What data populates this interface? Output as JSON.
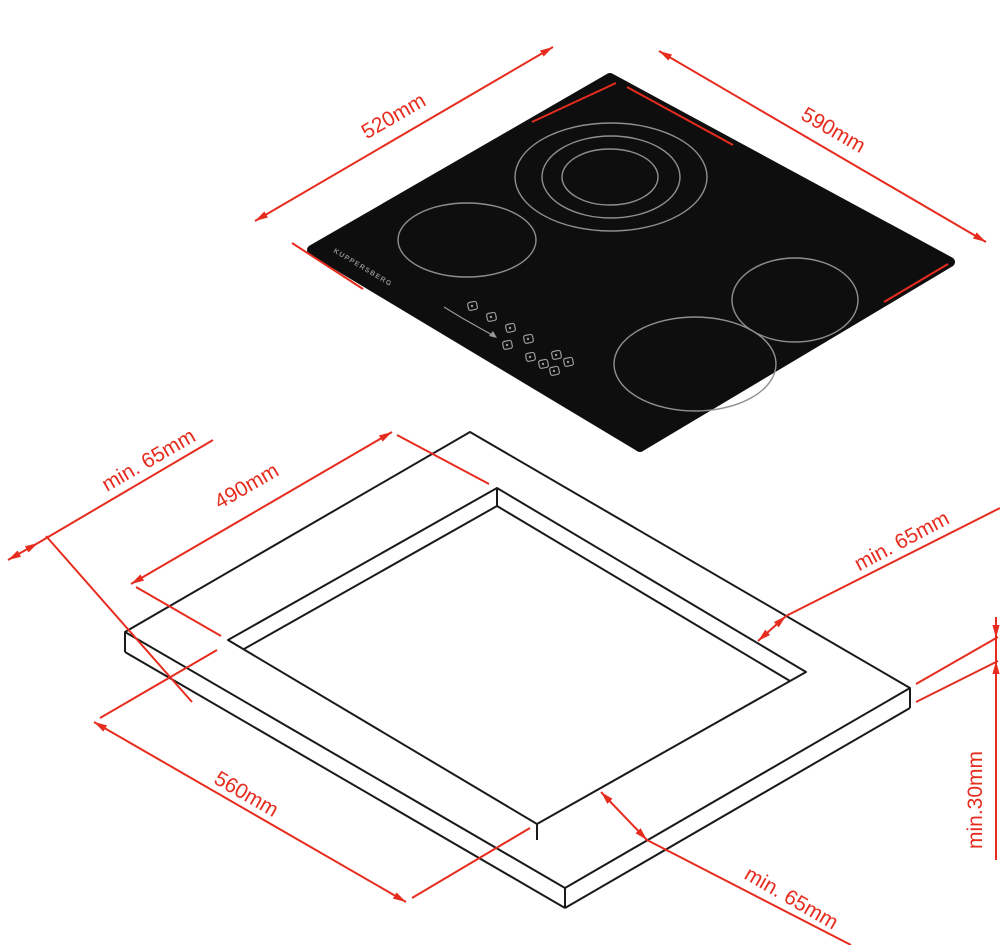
{
  "drawing": {
    "type": "installation-dimensions-diagram",
    "views": {
      "top_view": "ceramic hob with 4 burners, isometric",
      "bottom_view": "worktop cutout, isometric"
    },
    "brand": "KUPPERSBERG",
    "labels": {
      "hob_width": "520mm",
      "hob_depth": "590mm",
      "cutout_depth": "490mm",
      "cutout_width": "560mm",
      "clearance_rear": "min. 65mm",
      "clearance_right": "min. 65mm",
      "clearance_front": "min. 65mm",
      "worktop_thickness": "min.30mm"
    },
    "colors": {
      "dimension_red": "#e62c1e",
      "hob_surface": "#0e0e0e",
      "outline_black": "#1a1a1a",
      "burner_ring_gray": "#8f8f8f",
      "control_gray": "#9a9a9a",
      "background": "#ffffff"
    },
    "burner_count": 4
  }
}
